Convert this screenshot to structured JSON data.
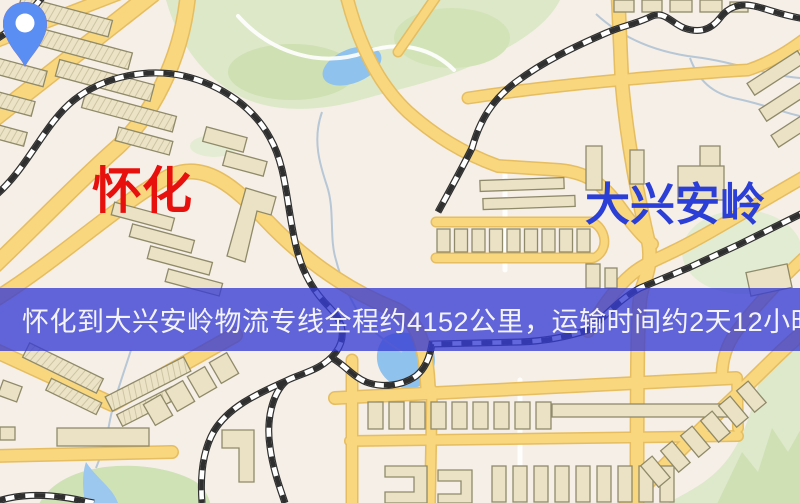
{
  "banner": {
    "text": "怀化到大兴安岭物流专线全程约4152公里，运输时间约2天12小时."
  },
  "markers": {
    "origin": {
      "label": "怀化",
      "pin_color": "#f31a10",
      "label_color": "#e8100c"
    },
    "destination": {
      "label": "大兴安岭",
      "pin_color": "#5b8ef2",
      "label_color": "#2b3fd6"
    }
  },
  "map": {
    "palette": {
      "background": "#f6efe7",
      "road_yellow": "#f8d77e",
      "road_casing": "#e6bd60",
      "park_green": "#dce8c8",
      "water_blue": "#8fc2ec",
      "building_fill": "#ebe2c5",
      "building_outline": "#8f8a6a",
      "railway": "#2f2f2f",
      "banner_overlay": "rgba(55,60,212,0.78)"
    }
  }
}
